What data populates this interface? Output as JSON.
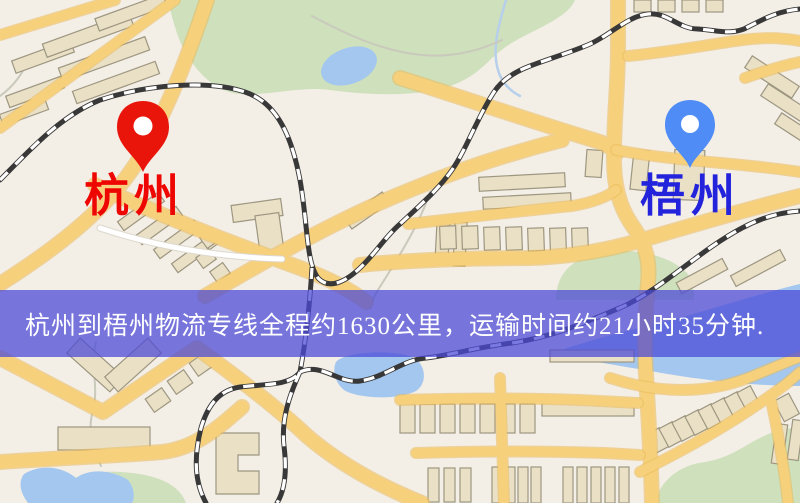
{
  "banner": {
    "text": "杭州到梧州物流专线全程约1630公里，运输时间约21小时35分钟.",
    "text_color": "#ffffff",
    "overlay_color": "rgba(76,74,214,0.74)"
  },
  "markers": {
    "origin": {
      "city": "杭州",
      "pin_icon": "location-pin-icon",
      "pin_color": "#e9150b",
      "label_color": "#ee0602"
    },
    "destination": {
      "city": "梧州",
      "pin_icon": "location-pin-icon",
      "pin_color": "#4f8cf6",
      "label_color": "#2323dc"
    }
  },
  "map": {
    "palette": {
      "land": "#f3eee6",
      "park": "#cfe0bd",
      "water": "#a3c7ef",
      "stream": "#b6d0ec",
      "building": "#eae0c6",
      "building-stroke": "#9d9680",
      "road": "#f6d07b",
      "road-casing": "#eaba58",
      "minor-road": "#ffffff",
      "railway-dark": "#383838",
      "railway-light": "#ffffff"
    }
  }
}
